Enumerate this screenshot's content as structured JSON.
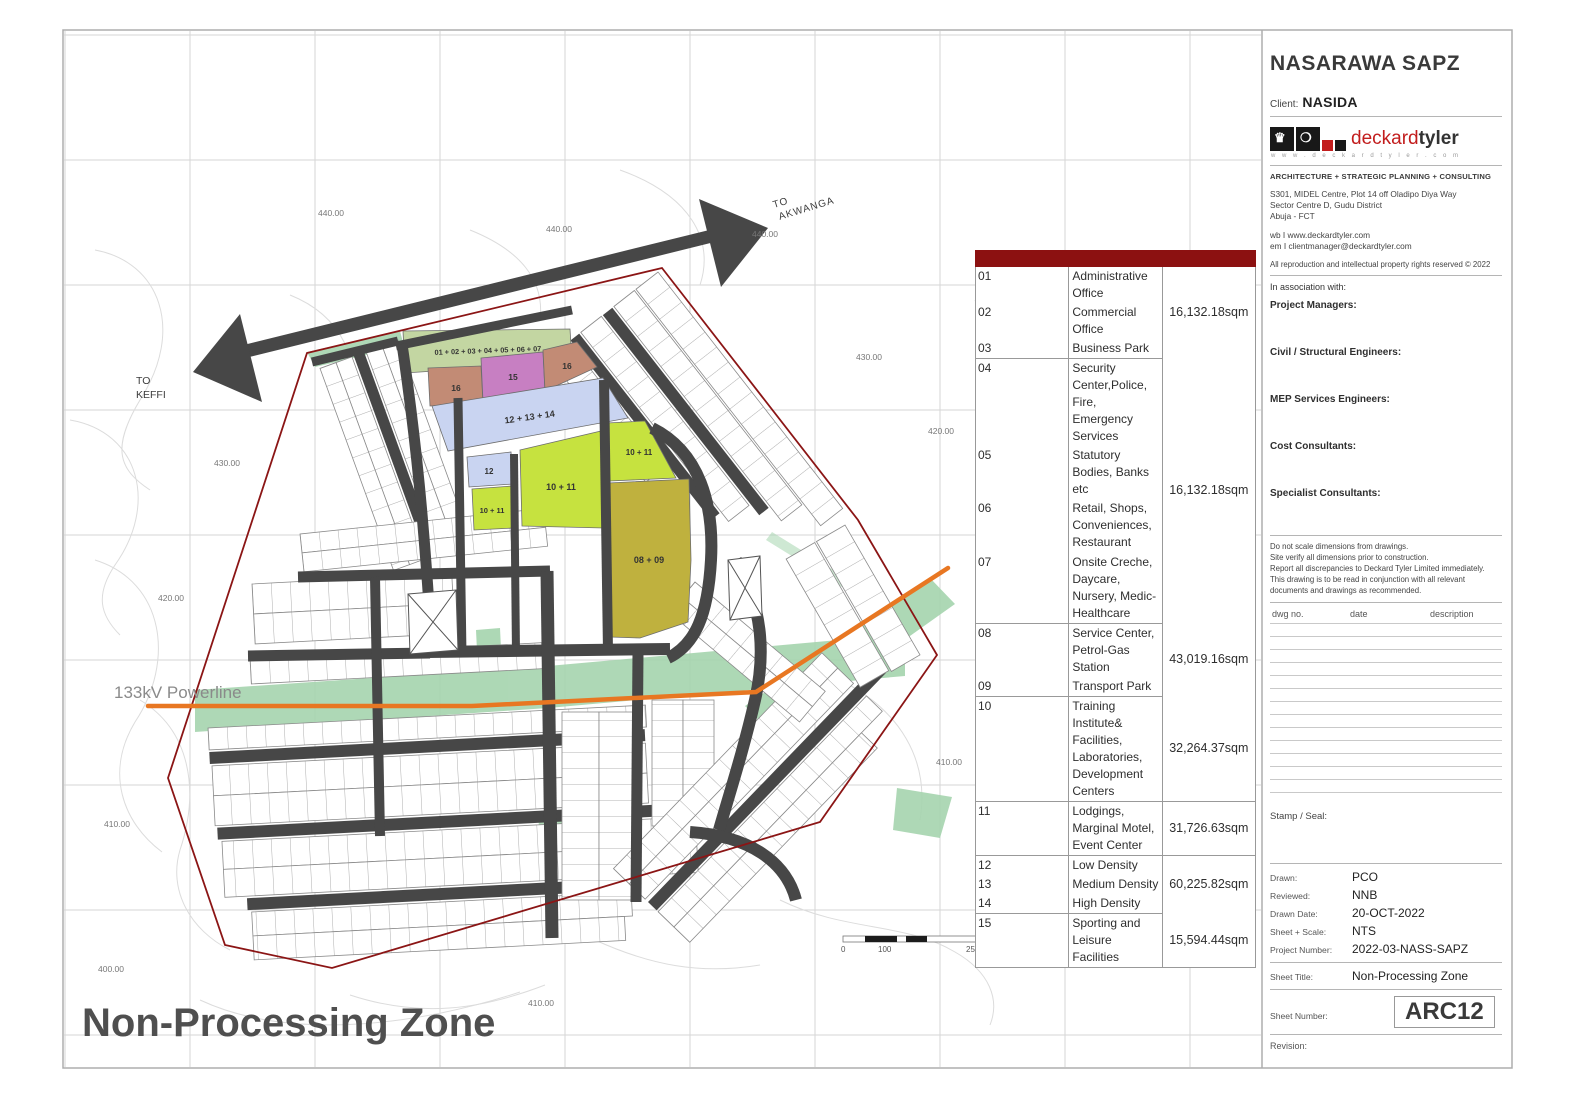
{
  "titleblock": {
    "project_title": "NASARAWA SAPZ",
    "client_label": "Client:",
    "client_name": "NASIDA",
    "brand_first": "deckard",
    "brand_second": "tyler",
    "brand_url": "w w w . d e c k a r d t y l e r . c o m",
    "tagline": "ARCHITECTURE  +  STRATEGIC PLANNING  +  CONSULTING",
    "address_line1": "S301, MIDEL Centre, Plot 14 off Oladipo Diya Way",
    "address_line2": "Sector Centre D, Gudu District",
    "address_line3": "Abuja - FCT",
    "web": "wb I www.deckardtyler.com",
    "email": "em I clientmanager@deckardtyler.com",
    "rights": "All reproduction and intellectual property rights reserved © 2022",
    "association": "In association with:",
    "roles": [
      "Project Managers:",
      "Civil / Structural Engineers:",
      "MEP Services Engineers:",
      "Cost Consultants:",
      "Specialist Consultants:"
    ],
    "notes": [
      "Do not scale dimensions from drawings.",
      "Site verify all dimensions prior to construction.",
      "Report all discrepancies to Deckard Tyler Limited immediately.",
      "This drawing is to be read in conjunction with all relevant",
      "documents and drawings as recommended."
    ],
    "rev_headers": [
      "dwg no.",
      "date",
      "description"
    ],
    "stamp_label": "Stamp / Seal:",
    "meta": [
      {
        "label": "Drawn:",
        "value": "PCO"
      },
      {
        "label": "Reviewed:",
        "value": "NNB"
      },
      {
        "label": "Drawn Date:",
        "value": "20-OCT-2022"
      },
      {
        "label": "Sheet + Scale:",
        "value": "NTS"
      },
      {
        "label": "Project Number:",
        "value": "2022-03-NASS-SAPZ"
      }
    ],
    "sheet_title_label": "Sheet Title:",
    "sheet_title": "Non-Processing Zone",
    "sheet_number_label": "Sheet Number:",
    "sheet_number": "ARC12",
    "revision_label": "Revision:"
  },
  "legend": {
    "groups": [
      {
        "items": [
          {
            "no": "01",
            "label": "Administrative Office"
          },
          {
            "no": "02",
            "label": "Commercial Office"
          },
          {
            "no": "03",
            "label": "Business Park"
          }
        ],
        "area": "16,132.18sqm"
      },
      {
        "items": [
          {
            "no": "04",
            "label": "Security Center,Police, Fire, Emergency Services"
          },
          {
            "no": "05",
            "label": "Statutory Bodies, Banks etc"
          },
          {
            "no": "06",
            "label": "Retail, Shops, Conveniences, Restaurant"
          },
          {
            "no": "07",
            "label": "Onsite Creche, Daycare, Nursery, Medic-Healthcare"
          }
        ],
        "area": "16,132.18sqm"
      },
      {
        "items": [
          {
            "no": "08",
            "label": "Service Center, Petrol-Gas Station"
          },
          {
            "no": "09",
            "label": "Transport Park"
          }
        ],
        "area": "43,019.16sqm"
      },
      {
        "items": [
          {
            "no": "10",
            "label": "Training Institute& Facilities, Laboratories, Development Centers"
          }
        ],
        "area": "32,264.37sqm"
      },
      {
        "items": [
          {
            "no": "11",
            "label": "Lodgings, Marginal Motel, Event Center"
          }
        ],
        "area": "31,726.63sqm"
      },
      {
        "items": [
          {
            "no": "12",
            "label": "Low Density"
          },
          {
            "no": "13",
            "label": "Medium Density"
          },
          {
            "no": "14",
            "label": "High Density"
          }
        ],
        "area": "60,225.82sqm"
      },
      {
        "items": [
          {
            "no": "15",
            "label": "Sporting and Leisure Facilities"
          }
        ],
        "area": "15,594.44sqm"
      }
    ]
  },
  "map": {
    "title": "Non-Processing Zone",
    "to_keffi": [
      "TO",
      "KEFFI"
    ],
    "to_akwanga": [
      "TO",
      "AKWANGA"
    ],
    "powerline_label": "133kV Powerline",
    "contour_labels": [
      "440.00",
      "440.00",
      "440.00",
      "430.00",
      "420.00",
      "430.00",
      "420.00",
      "410.00",
      "410.00",
      "400.00",
      "410.00"
    ],
    "block_labels": {
      "admin_group": "01 + 02 + 03 + 04 + 05 + 06 + 07",
      "b16_left": "16",
      "b15": "15",
      "b16_right": "16",
      "b12_13_14": "12 + 13 + 14",
      "b12": "12",
      "b10_11_left": "10 + 11",
      "b10_11_center": "10 + 11",
      "b10_11_right": "10 + 11",
      "b08_09": "08 + 09"
    },
    "scale_labels": [
      "0",
      "100",
      "250"
    ]
  },
  "colors": {
    "legend_header": "#8C1111",
    "road": "#474747",
    "boundary": "#8B1515",
    "powerline": "#E87722",
    "green_open_space": "#A5D4AE",
    "block_admin": "#C3D6A2",
    "block_16": "#C28B75",
    "block_15": "#C77FC2",
    "block_residential": "#C9D4F1",
    "block_10_11": "#C6E23F",
    "block_08_09": "#BFB13E"
  }
}
